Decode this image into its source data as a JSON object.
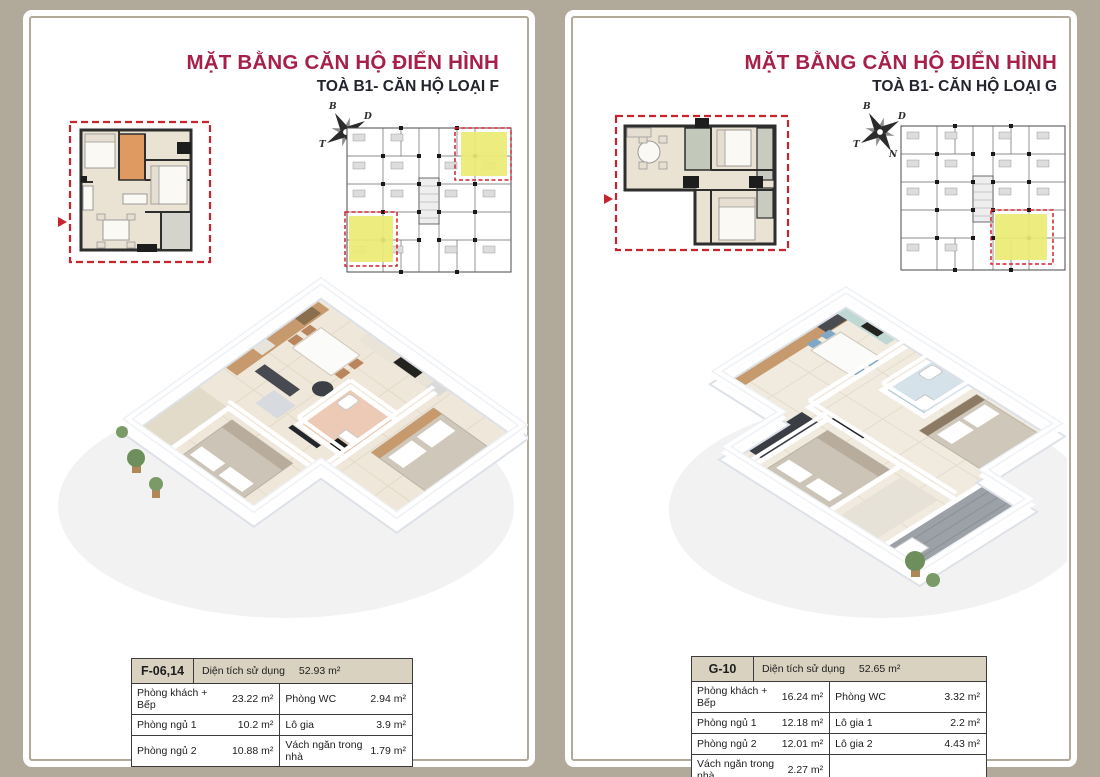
{
  "brand": {
    "accent_red": "#a72049",
    "dash_red": "#c8242e",
    "highlight_yellow": "#ecec74",
    "paper_taupe": "#b1aa9a",
    "table_header_bg": "#d9d2c1"
  },
  "pages": [
    {
      "type_label": "F",
      "title": "MẶT BẰNG CĂN HỘ ĐIỂN HÌNH",
      "subtitle": "TOÀ B1- CĂN HỘ LOẠI F",
      "compass": {
        "north": "B",
        "east": "D",
        "south": "N",
        "west": "T"
      },
      "table": {
        "unit_code": "F-06,14",
        "area_label": "Diện tích sử dụng",
        "area_value": "52.93 m²",
        "rows": [
          {
            "c1_label": "Phòng khách + Bếp",
            "c1_value": "23.22 m²",
            "c2_label": "Phòng WC",
            "c2_value": "2.94 m²"
          },
          {
            "c1_label": "Phòng ngủ 1",
            "c1_value": "10.2 m²",
            "c2_label": "Lô gia",
            "c2_value": "3.9 m²"
          },
          {
            "c1_label": "Phòng ngủ 2",
            "c1_value": "10.88 m²",
            "c2_label": "Vách ngăn trong nhà",
            "c2_value": "1.79 m²"
          }
        ]
      }
    },
    {
      "type_label": "G",
      "title": "MẶT BẰNG CĂN HỘ ĐIỂN HÌNH",
      "subtitle": "TOÀ B1- CĂN HỘ LOẠI G",
      "compass": {
        "north": "B",
        "east": "D",
        "south": "N",
        "west": "T"
      },
      "table": {
        "unit_code": "G-10",
        "area_label": "Diện tích sử dụng",
        "area_value": "52.65 m²",
        "rows": [
          {
            "c1_label": "Phòng khách + Bếp",
            "c1_value": "16.24 m²",
            "c2_label": "Phòng WC",
            "c2_value": "3.32 m²"
          },
          {
            "c1_label": "Phòng ngủ 1",
            "c1_value": "12.18 m²",
            "c2_label": "Lô gia 1",
            "c2_value": "2.2 m²"
          },
          {
            "c1_label": "Phòng ngủ 2",
            "c1_value": "12.01 m²",
            "c2_label": "Lô gia 2",
            "c2_value": "4.43 m²"
          },
          {
            "c1_label": "Vách ngăn trong nhà",
            "c1_value": "2.27 m²",
            "c2_label": "",
            "c2_value": ""
          }
        ]
      }
    }
  ]
}
